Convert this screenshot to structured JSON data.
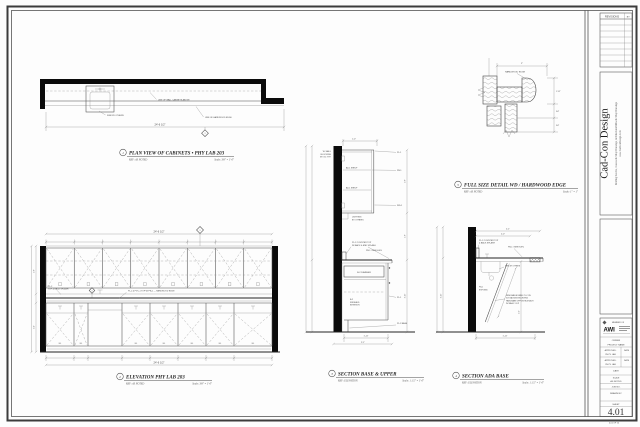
{
  "sheet": {
    "revisions": {
      "header": "REVISIONS",
      "by": "BY"
    },
    "company": {
      "name": "Cad-Con Design",
      "line1": "Drafting Service, Casework Shop Drawings, Architectural Millwork Shop Drawings",
      "line2": "www.CadConDesign.Com"
    },
    "tb": {
      "member_of": "MEMBER OF",
      "awi": "AWI",
      "owner": "OWNER",
      "project": "PROJECT NAME",
      "approved": "APPROVED:",
      "approved_sub": "PHYS. LAB",
      "date_col": "DATE",
      "date": "DATE",
      "scale": "SCALE",
      "scale_val": "AS NOTED",
      "job": "JOB NO.",
      "drawn": "DRAWN BY:",
      "sheet": "SHEET",
      "number": "4.01",
      "of": "4.01 OF 10"
    }
  },
  "views": {
    "plan": {
      "num": "1",
      "title": "PLAN VIEW OF CABINETS • PHY LAB 203",
      "ref": "REF:  AS NOTED",
      "scale": "Scale:  3/8\" = 1'-0\"",
      "ann_wall_cabs": "LINE OF WALL CABINETS ABOVE",
      "ann_sink": "SINK BY OTHERS",
      "ann_edge": "LINE OF HARDWOOD EDGE",
      "dim_overall": "24'-6 1/2\"",
      "marker": "3"
    },
    "elevation": {
      "num": "2",
      "title": "ELEVATION PHY LAB 203",
      "ref": "REF:  AS NOTED",
      "scale": "Scale:  3/8\" = 1'-0\"",
      "dim_top": "24'-6 1/2\"",
      "dim_bottom": "24'-6 1/2\"",
      "ann_splash_1": "PL-2",
      "ann_splash_2": "TOP & BACK SPLASH",
      "ann_top": "PL-2 & PVC-1 TOP W/ PB-1 — HARDWOOD EDGE",
      "marker_top": "3",
      "marker_mid": "4",
      "b1": "B-1",
      "dim_left_upper": "2'-6\"",
      "dim_left_base": "3'-0\""
    },
    "section_bu": {
      "num": "3",
      "title": "SECTION BASE & UPPER",
      "ref": "REF:  ELEVATION",
      "scale": "Scale:  1 1/2\" = 1'-0\"",
      "ann_clear": "1'-0\"",
      "ann_blocking_1": "W. WALL",
      "ann_blocking_2": "BLOCKING",
      "ann_blocking_3": "BY GC TYP.",
      "shelf": "ADJ. SHELF",
      "ann_light_1": "LIGHTING",
      "ann_light_2": "BY OTHERS",
      "ann_counter_1": "PL-2 COUNTER TOP",
      "ann_counter_2": "W/ BACK & END SPLASH",
      "ann_pb1": "PB-1 / SEE ELEV.",
      "drawer": "B-2 DRAWER",
      "int_1": "B-2",
      "int_2": "FINISHED",
      "int_3": "INTERIOR",
      "leaders": [
        "PL-1",
        "PB-1",
        "WD-1",
        "PL-1",
        "PL-2 BASE"
      ],
      "dim_b1": "1'-11\"",
      "dim_b2": "2'-1\"",
      "dim_r1": "2'-6\"",
      "dim_r2": "1'-6\"",
      "dim_r3": "2'-10\""
    },
    "section_ada": {
      "num": "4",
      "title": "SECTION ADA BASE",
      "ref": "REF:  ELEVATION",
      "scale": "Scale:  1 1/2\" = 1'-0\"",
      "dim_t1": "2'-1\"",
      "dim_t2": "2'-0\"",
      "ann_counter_1": "PL-2 COUNTER TOP",
      "ann_counter_2": "& BACK SPLASH",
      "ann_pb1": "PB-1 / SEE ELEV.",
      "ann_sink": "SINK BY OTHERS",
      "ann_exp_1": "PB-1",
      "ann_exp_2": "EXPOSED",
      "panel_1": "REMOVABLE PANEL PL-2 ON",
      "panel_2": "3/4\" BACKING MOUNTING",
      "panel_3": "HARDWARE OPPOSITE ATTACH",
      "panel_4": "W/ MAGIC CLIP",
      "dim_bottom": "1'-11\"",
      "dim_left": "2'-10\"",
      "dim_right": "2'-3\""
    },
    "detail": {
      "num": "5",
      "title": "FULL SIZE DETAIL WD / HARDWOOD EDGE",
      "ref": "REF:  AS NOTED",
      "scale": "Scale:  1\" = 1\"",
      "ann_edge": "HARDWOOD EDGE",
      "dim_top": "2\"",
      "dim_r1": "1 1/2\"",
      "dim_r2": "3/4\"",
      "dim_r3": "3/4\""
    }
  }
}
